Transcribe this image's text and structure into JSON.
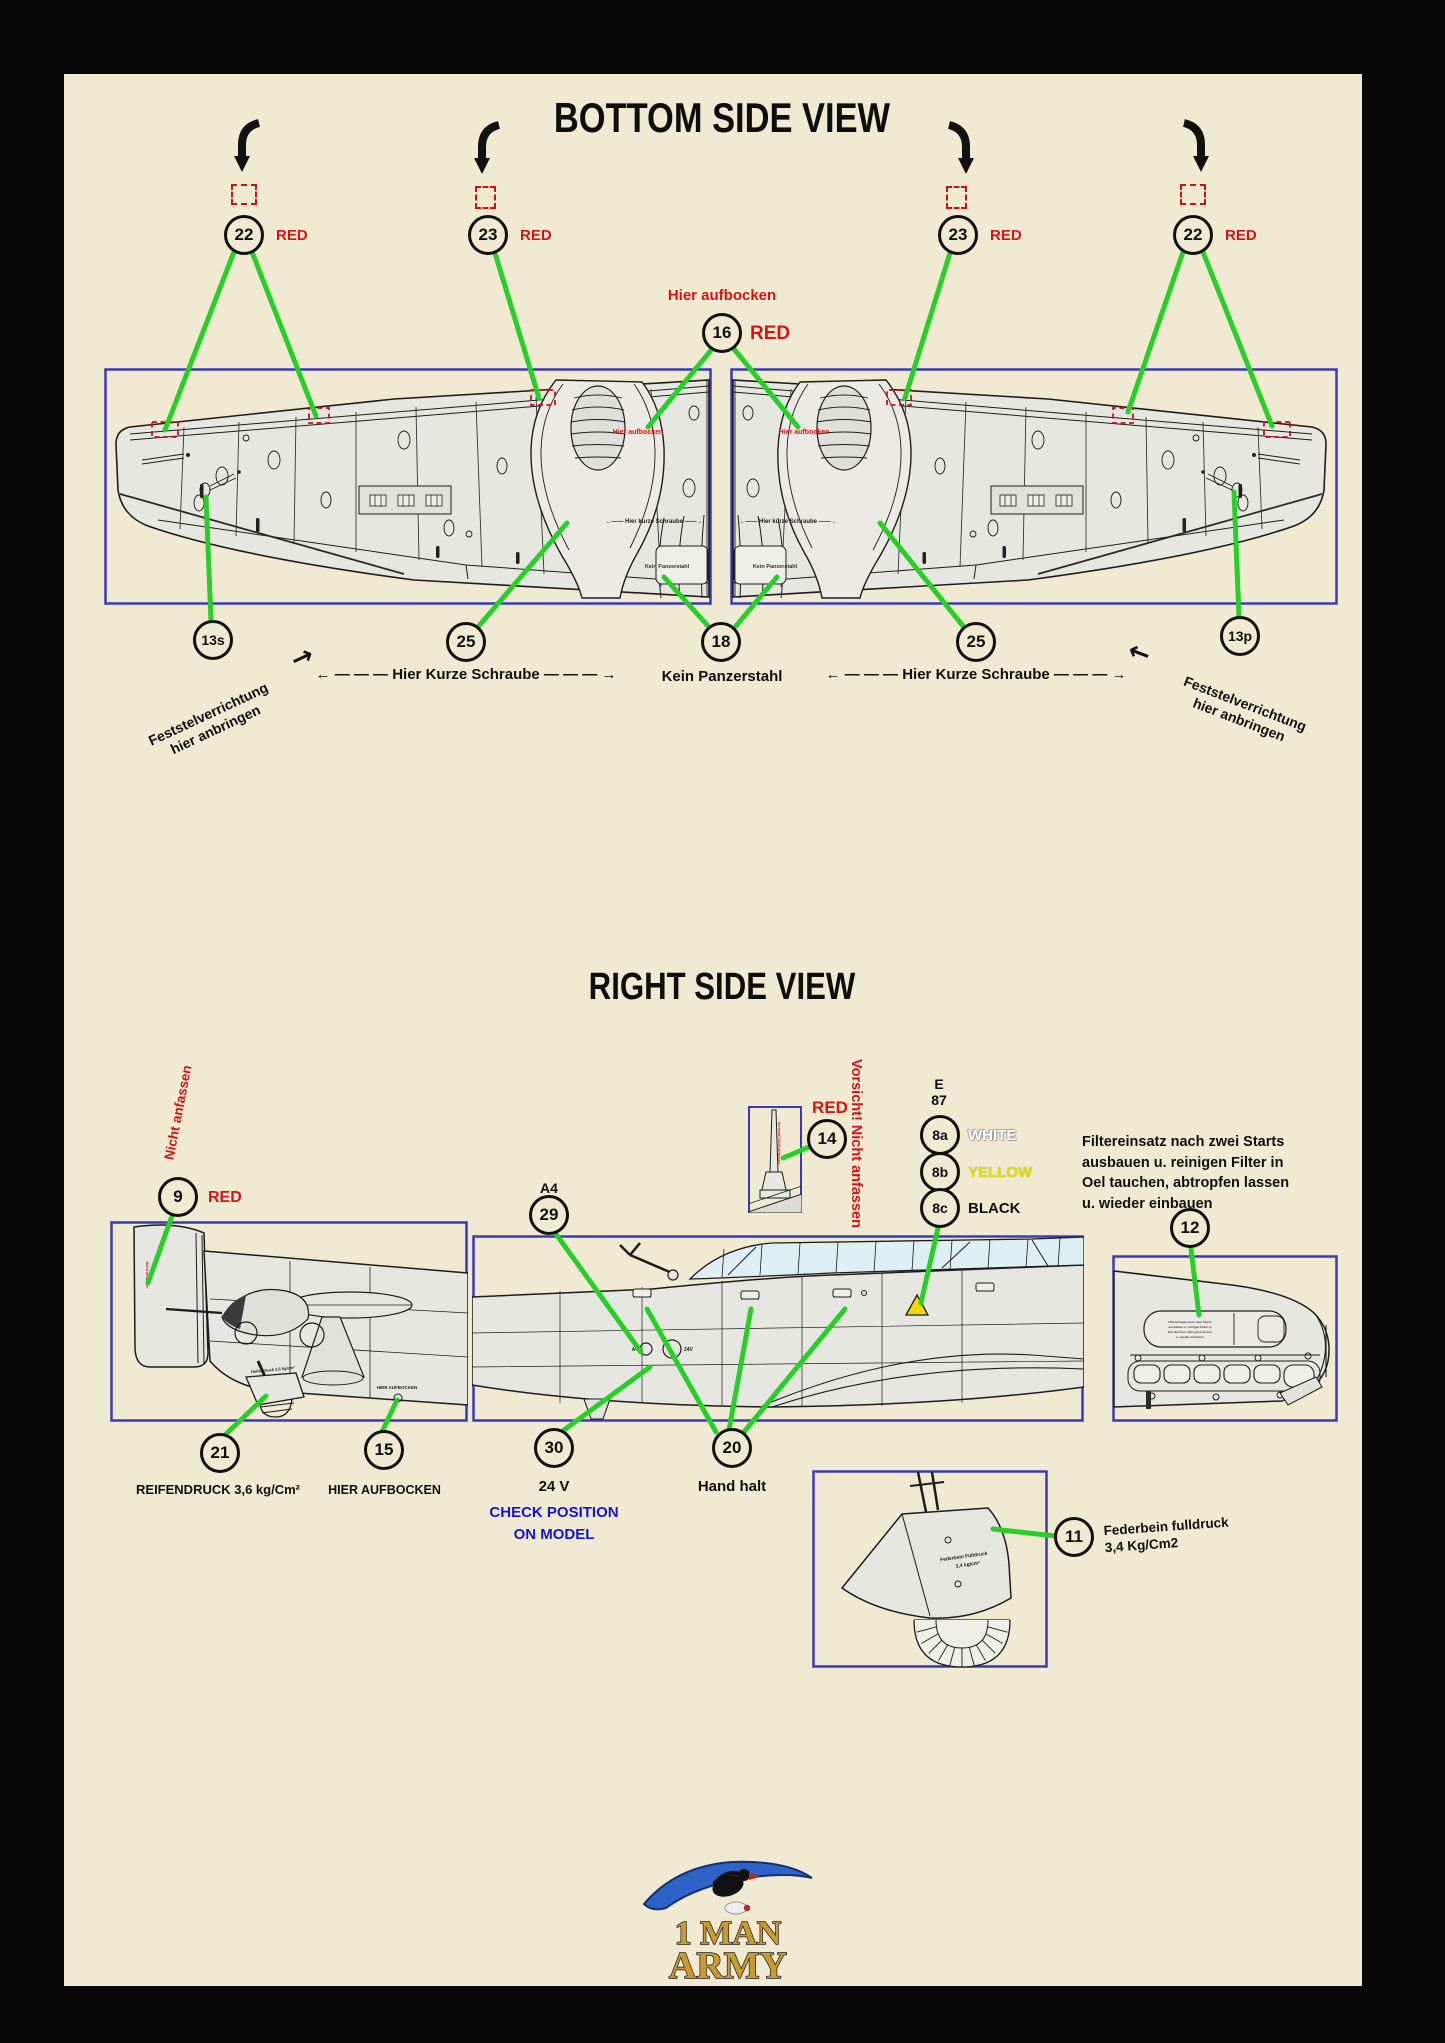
{
  "colors": {
    "paper": "#f0ead3",
    "frame": "#060606",
    "accent_green": "#29cf29",
    "accent_red": "#d41414",
    "box_blue": "#3a3ab8",
    "label_blue": "#1414cc",
    "stencil_yellow": "#e0e000",
    "logo_gold": "#c89b32"
  },
  "bottom_view": {
    "title": "BOTTOM SIDE VIEW",
    "arrow_left": "←",
    "arrow_right": "→",
    "dash": " — — — ",
    "rotate_callouts": [
      {
        "num": "22",
        "tag": "RED"
      },
      {
        "num": "23",
        "tag": "RED"
      },
      {
        "num": "23",
        "tag": "RED"
      },
      {
        "num": "22",
        "tag": "RED"
      }
    ],
    "jack": {
      "label": "Hier aufbocken",
      "num": "16",
      "tag": "RED"
    },
    "wing_annotations": {
      "hier_aufbocken": "Hier aufbocken",
      "kurze_schraube": "←—— Hier kurze Schraube ——→",
      "kein_panzerstahl": "Kein Panzerstahl"
    },
    "callout_13s": {
      "num": "13s",
      "label": "Feststelverrichtung\nhier anbringen"
    },
    "callout_25_left": {
      "num": "25",
      "label": "Hier Kurze Schraube"
    },
    "callout_18": {
      "num": "18",
      "label": "Kein Panzerstahl"
    },
    "callout_25_right": {
      "num": "25",
      "label": "Hier Kurze Schraube"
    },
    "callout_13p": {
      "num": "13p",
      "label": "Feststelverrichtung\nhier anbringen"
    }
  },
  "right_view": {
    "title": "RIGHT SIDE VIEW",
    "tail": {
      "num": "9",
      "tag": "RED",
      "warn": "Nicht anfassen",
      "tiny_tire": "Reifendruck 3,6 kg/cm²",
      "tire": {
        "num": "21",
        "label": "REIFENDRUCK 3,6 kg/Cm²"
      },
      "jack": {
        "num": "15",
        "label": "HIER AUFBOCKEN",
        "tiny": "HIER AUFBOCKEN"
      }
    },
    "antenna": {
      "num": "14",
      "tag": "RED",
      "warn_vertical": "Vorsicht! Nicht anfassen",
      "mast_text": "Vorsicht! Nicht anfassen"
    },
    "part29": {
      "code": "A4",
      "num": "29"
    },
    "fuselage_tiny": {
      "a4": "A4",
      "v24": "24V"
    },
    "stencil": {
      "e": "E",
      "n": "87",
      "a": {
        "num": "8a",
        "label": "WHITE"
      },
      "b": {
        "num": "8b",
        "label": "YELLOW"
      },
      "c": {
        "num": "8c",
        "label": "BLACK"
      }
    },
    "filter": {
      "num": "12",
      "lines": [
        "Filtereinsatz nach zwei Starts",
        "ausbauen u. reinigen Filter in",
        "Oel tauchen, abtropfen lassen",
        "u. wieder einbauen"
      ]
    },
    "volt": {
      "num": "30",
      "label": "24 V",
      "check1": "CHECK POSITION",
      "check2": "ON MODEL"
    },
    "hand": {
      "num": "20",
      "label": "Hand halt"
    },
    "strut": {
      "num": "11",
      "line1": "Federbein fulldruck",
      "line2": "3,4 Kg/Cm2",
      "tiny1": "Federbein Fülldruck",
      "tiny2": "3,4 kg/cm²"
    }
  },
  "logo": {
    "line1": "1 MAN",
    "line2": "ARMY"
  }
}
